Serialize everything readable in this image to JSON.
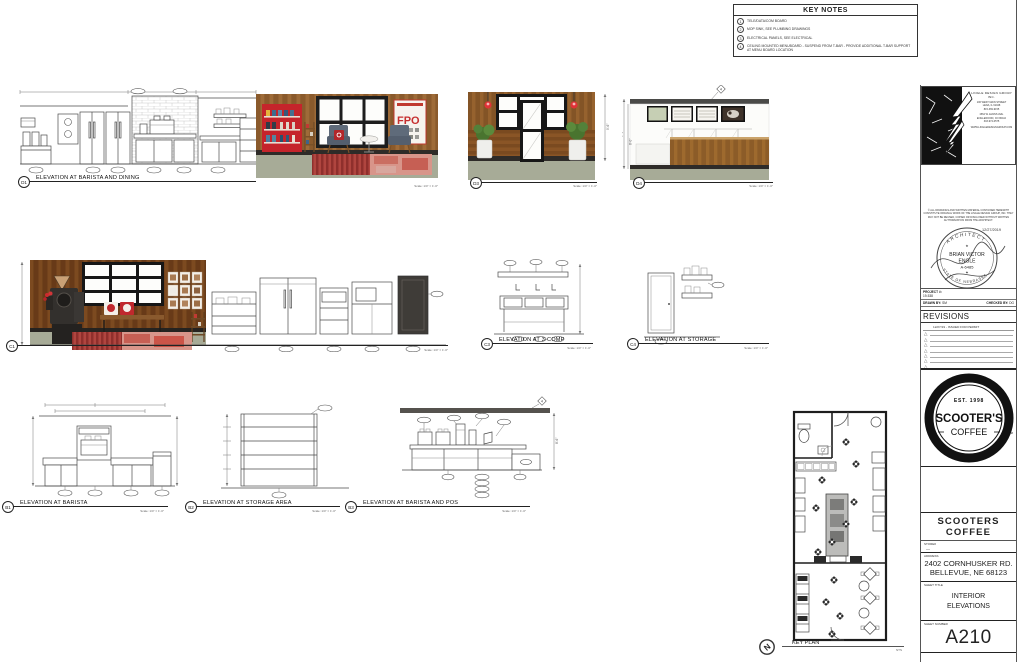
{
  "sheet": {
    "key_notes": {
      "title": "KEY NOTES",
      "notes": [
        {
          "num": "1",
          "text": "TELE/DATA/COM BOARD"
        },
        {
          "num": "2",
          "text": "MOP SINK, SEE PLUMBING DRAWINGS"
        },
        {
          "num": "3",
          "text": "ELECTRICAL PANELS, SEE ELECTRICAL"
        },
        {
          "num": "4",
          "text": "CEILING MOUNTED MENUBOARD - SUSPEND FROM T-BAR - PROVIDE ADDITIONAL T-BAR SUPPORT AT MENU BOARD LOCATION"
        }
      ]
    },
    "elevations": [
      {
        "id": "D1",
        "title": "ELEVATION AT BARISTA AND DINING",
        "scale": "Scale: 1/4\" = 1'-0\""
      },
      {
        "id": "D3",
        "title": "",
        "scale": "Scale: 1/4\" = 1'-0\""
      },
      {
        "id": "D4",
        "title": "",
        "scale": "Scale: 1/4\" = 1'-0\""
      },
      {
        "id": "C1",
        "title": "",
        "scale": "Scale: 1/4\" = 1'-0\""
      },
      {
        "id": "C3",
        "title": "ELEVATION AT 3-COMP",
        "scale": "Scale: 1/4\" = 1'-0\""
      },
      {
        "id": "C4",
        "title": "ELEVATION AT STORAGE",
        "scale": "Scale: 1/4\" = 1'-0\""
      },
      {
        "id": "B1",
        "title": "ELEVATION AT BARISTA",
        "scale": "Scale: 1/4\" = 1'-0\""
      },
      {
        "id": "B2",
        "title": "ELEVATION AT STORAGE AREA",
        "scale": "Scale: 1/4\" = 1'-0\""
      },
      {
        "id": "B3",
        "title": "ELEVATION AT BARISTA AND POS",
        "scale": "Scale: 1/4\" = 1'-0\""
      }
    ],
    "dims": {
      "d3_height": "9'-6\"",
      "d4_outer": "9'-6\"",
      "d4_inner": "8'-0\"",
      "b3_height": "8'-6\""
    },
    "keynote_tag": "4",
    "artwork": {
      "fpo": "FPO"
    },
    "key_plan": {
      "label": "KEY PLAN",
      "scale": "NTS",
      "north_letter": "N"
    }
  },
  "title_block": {
    "firm": {
      "lines": [
        "LINGLE DESIGN GROUP INC.",
        "106 WEST MAIN STREET",
        "LENA, IL 61048",
        "815-369-9155",
        "1564 W. EVANS AVE.",
        "ENGLEWOOD, CO 80110",
        "303-974-0575",
        "WWW.LINGLEDESIGNGROUP.COM"
      ]
    },
    "disclaimer": "© ALL DRAWINGS AND WRITTEN MATERIAL CONTAINED HEREWITH CONSTITUTE ORIGINAL WORK OF THE LINGLE DESIGN GROUP, INC. THEY MAY NOT BE REUSED, COPIED OR DISCLOSED WITHOUT WRITTEN AUTHORIZATION FROM THE ARCHITECT.",
    "stamp": {
      "date": "12/27/2019",
      "arc_top": "ARCHITECT",
      "name1": "BRIAN VICTOR",
      "name2": "ENGLE",
      "license": "A-6485",
      "arc_bottom": "STATE OF NEBRASKA"
    },
    "project_label": "PROJECT #:",
    "project_number": "19-538",
    "drawn_by_label": "DRAWN BY:",
    "drawn_by": "SM",
    "checked_by_label": "CHECKED BY:",
    "checked_by": "DG",
    "revisions_title": "REVISIONS",
    "revision_entry": "12/27/19 - ISSUED FOR PERMIT",
    "logo": {
      "est": "EST. 1998",
      "name": "SCOOTER'S",
      "word": "COFFEE",
      "tm": "TM"
    },
    "company": "SCOOTERS COFFEE",
    "store_label": "STORE#",
    "store_value": "—",
    "address_label": "ADDRESS",
    "address_line1": "2402 CORNHUSKER RD.",
    "address_line2": "BELLEVUE, NE 68123",
    "sheet_title_label": "SHEET TITLE",
    "sheet_title_line1": "INTERIOR",
    "sheet_title_line2": "ELEVATIONS",
    "sheet_number_label": "SHEET NUMBER",
    "sheet_number": "A210"
  }
}
